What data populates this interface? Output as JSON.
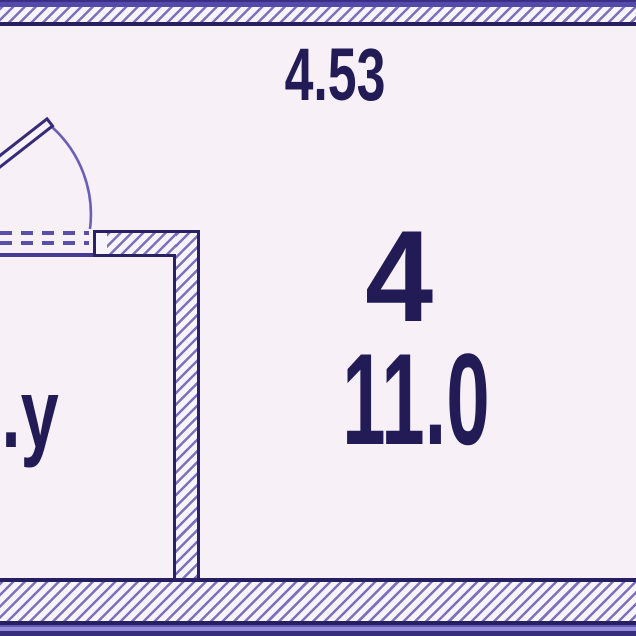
{
  "plan": {
    "top_dimension": "4.53",
    "room_main": {
      "number": "4",
      "area": "11.0"
    },
    "room_bathroom": {
      "label": "С.у"
    }
  },
  "colors": {
    "background": "#f8f0f7",
    "wall_outline": "#2b2266",
    "hatch_line": "#7d71bd",
    "hatch_background": "#f8f4fc",
    "text": "#221b56",
    "frame_purple": "#544aa9",
    "frame_dark_line": "#261f60",
    "door_arc": "#6a5fb8",
    "door_dash": "#5a4fa8"
  }
}
